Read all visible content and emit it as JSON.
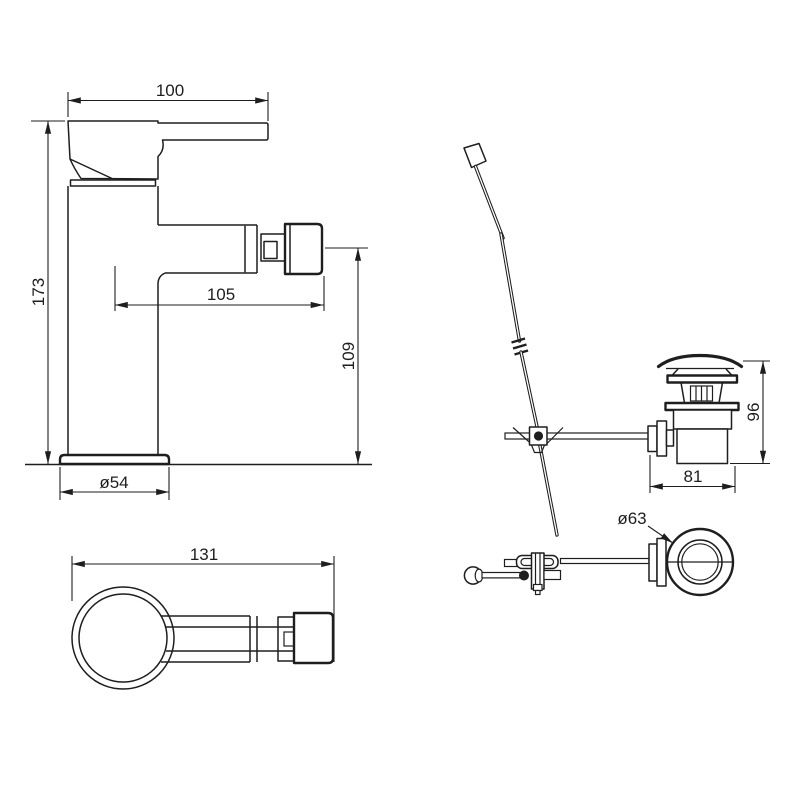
{
  "drawing": {
    "alt": "bidet-mixer-tap-with-pop-up-waste-dimension-drawing",
    "background": "#ffffff",
    "line_color": "#1e1e1e",
    "views": {
      "faucet_side": {
        "label": "faucet-side-view",
        "dims": {
          "handle_length": "100",
          "overall_height": "173",
          "spout_reach": "105",
          "spout_axis_height": "109",
          "base_diameter": "ø54"
        }
      },
      "faucet_top": {
        "label": "faucet-top-view",
        "dims": {
          "overall_length": "131"
        }
      },
      "drain_side": {
        "label": "pop-up-waste-side-view",
        "dims": {
          "height": "96",
          "width": "81"
        }
      },
      "drain_top": {
        "label": "pop-up-waste-top-view",
        "dims": {
          "flange_diameter": "ø63"
        }
      }
    }
  }
}
